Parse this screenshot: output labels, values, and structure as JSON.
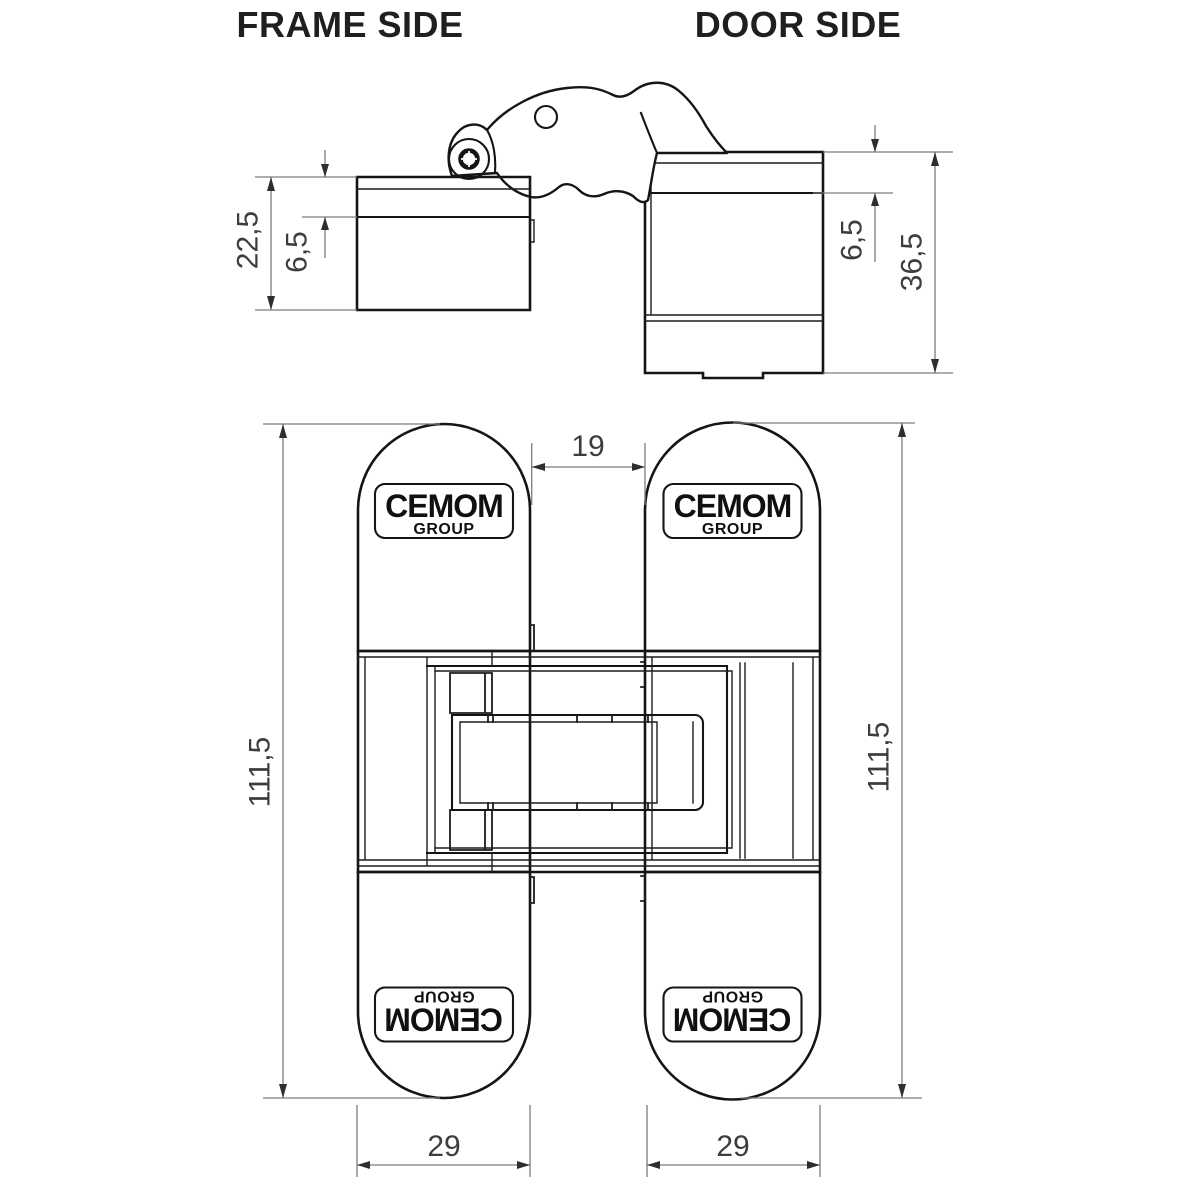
{
  "drawing": {
    "titles": {
      "left": "FRAME SIDE",
      "right": "DOOR SIDE"
    },
    "brand": {
      "name": "CEMOM",
      "sub": "GROUP"
    },
    "colors": {
      "line": "#151515",
      "dimension": "#7d7d7d",
      "text": "#3d3d3d"
    },
    "top_view": {
      "dims": {
        "frame_total_depth": "22,5",
        "frame_flange_depth": "6,5",
        "door_flange_depth": "6,5",
        "door_total_depth": "36,5"
      }
    },
    "front_view": {
      "dims": {
        "gap_width": "19",
        "frame_length": "111,5",
        "door_length": "111,5",
        "frame_width": "29",
        "door_width": "29"
      }
    }
  }
}
